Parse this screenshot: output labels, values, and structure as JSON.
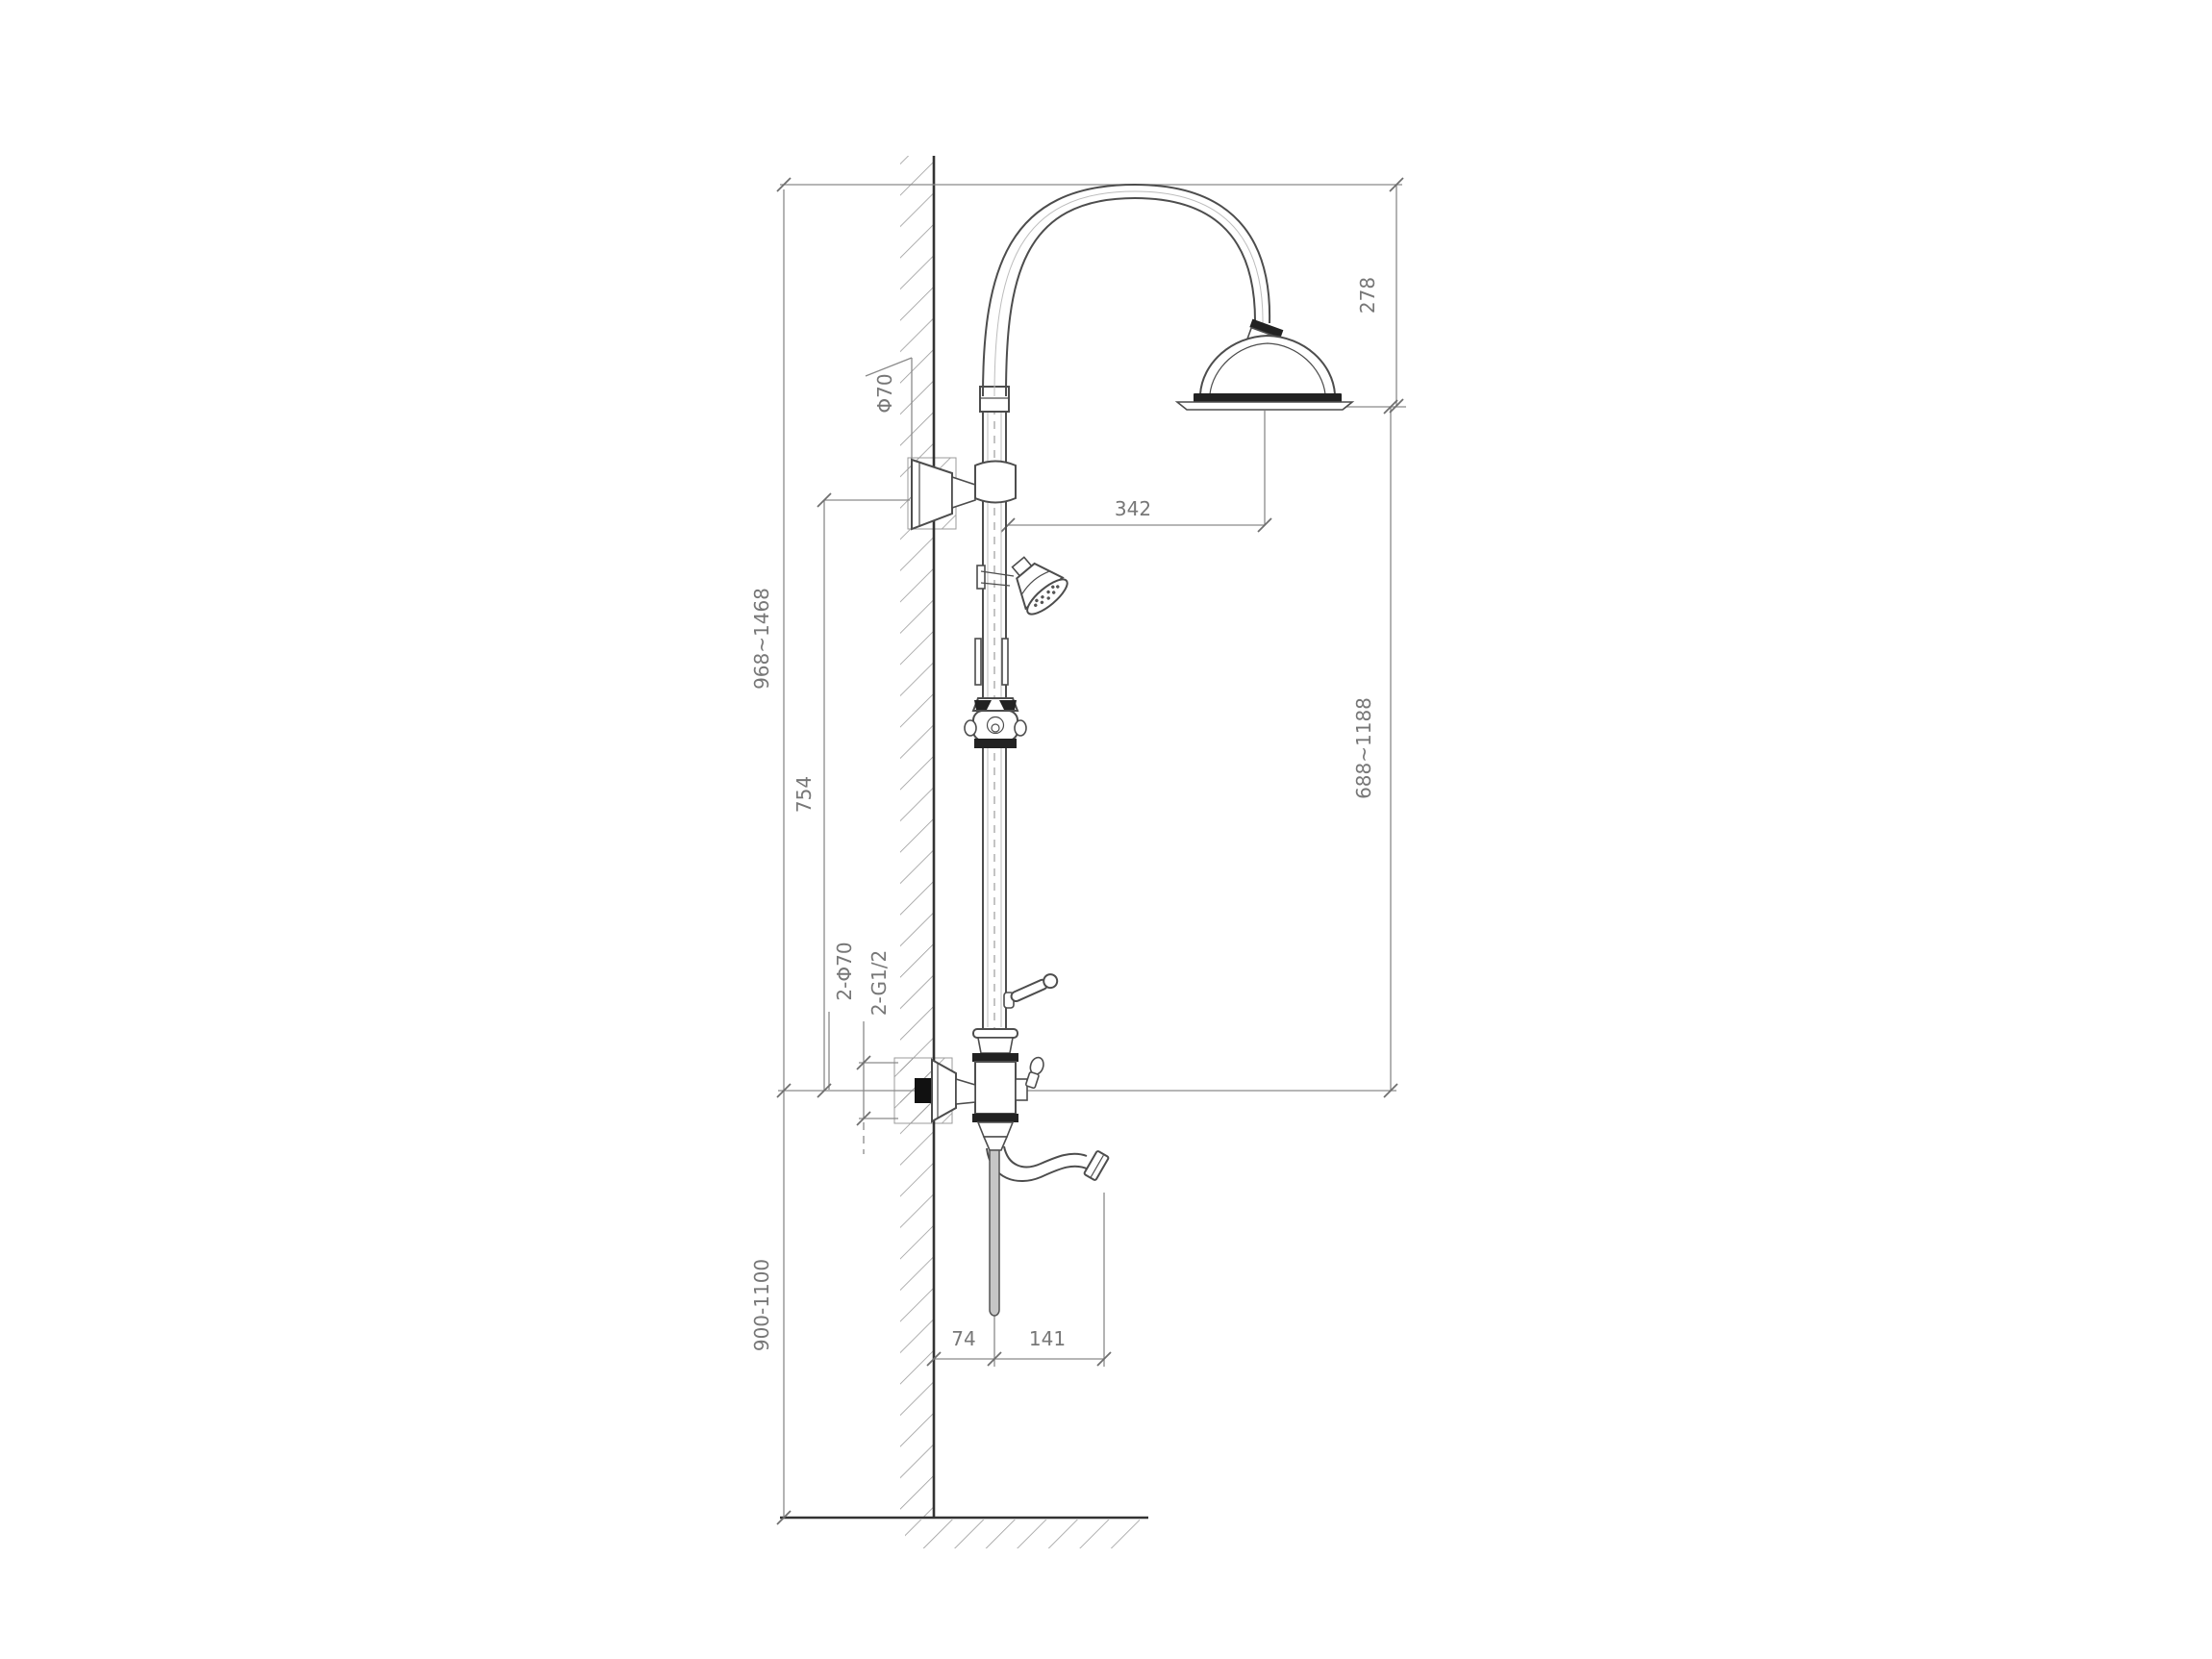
{
  "drawing": {
    "title": "wall-mounted shower column technical drawing",
    "labels": {
      "dia_top_bracket": "Φ70",
      "head_drop": "278",
      "head_offset": "342",
      "upper_height_range": "968~1468",
      "bracket_height": "754",
      "head_to_mixer_range": "688~1188",
      "mixer_floor_range": "900-1100",
      "wall_to_column": "74",
      "column_to_spout": "141",
      "ports_dia": "2-Φ70",
      "ports_thread": "2-G1/2"
    },
    "colors": {
      "line": "#4d4d4d",
      "dim_line": "#8a8a8a",
      "text": "#777777",
      "dark_band": "#222222",
      "hatch": "#9b9b9b",
      "background": "#ffffff"
    }
  }
}
